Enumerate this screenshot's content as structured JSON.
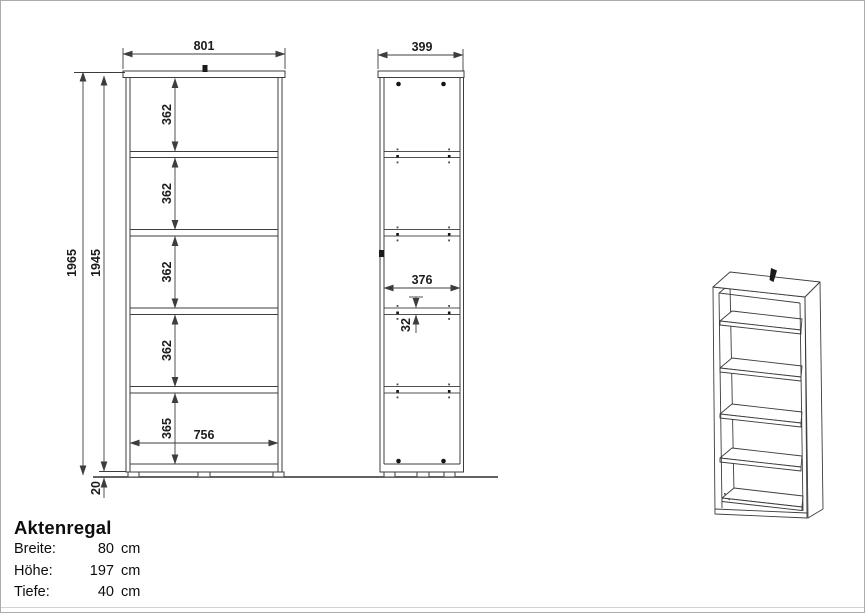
{
  "front_view": {
    "width_label": "801",
    "inner_width_label": "756",
    "total_height_label": "1965",
    "body_height_label": "1945",
    "plinth_height_label": "20",
    "section_labels": [
      "362",
      "362",
      "362",
      "362"
    ],
    "bottom_section_label": "365"
  },
  "side_view": {
    "depth_label": "399",
    "inner_depth_label": "376",
    "shelf_thickness_label": "32"
  },
  "title_block": {
    "title": "Aktenregal",
    "specs": [
      {
        "label": "Breite:",
        "value": "80",
        "unit": "cm"
      },
      {
        "label": "Höhe:",
        "value": "197",
        "unit": "cm"
      },
      {
        "label": "Tiefe:",
        "value": "40",
        "unit": "cm"
      }
    ]
  },
  "colors": {
    "line": "#3d3d3d",
    "background": "#ffffff",
    "text": "#1c1c1c"
  }
}
